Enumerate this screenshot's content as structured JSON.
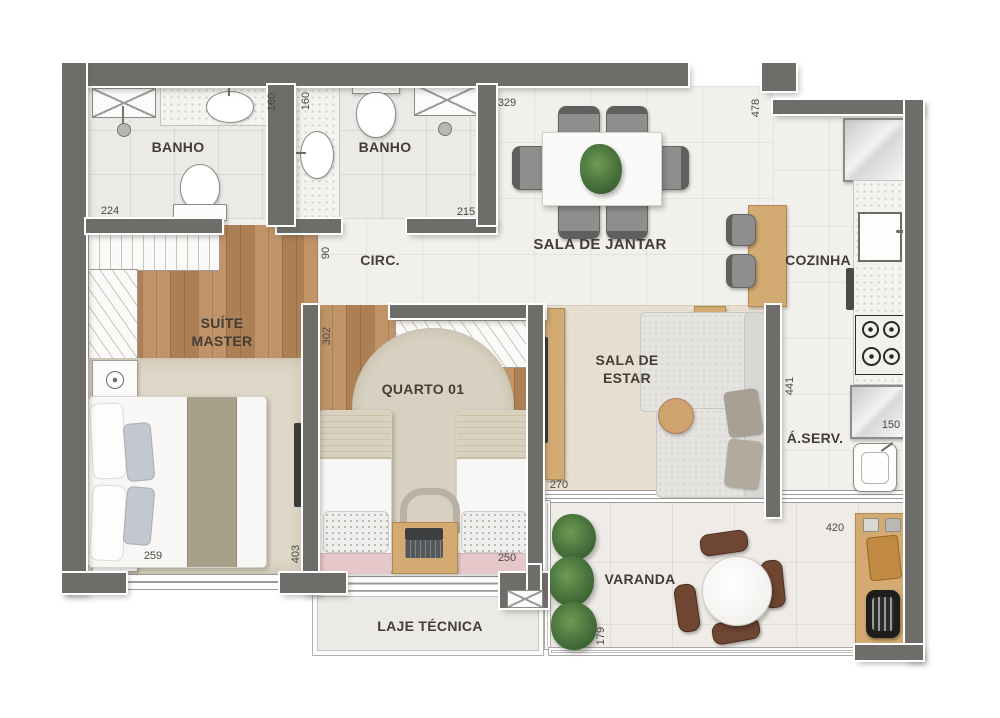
{
  "palette": {
    "wall": "#6f6d6a",
    "wood_floor": "#b98c60",
    "counter_wood": "#d3aa72",
    "plant_green": "#47703b"
  },
  "rooms": {
    "banho1": "BANHO",
    "banho2": "BANHO",
    "circ": "CIRC.",
    "sala_jantar": "SALA DE JANTAR",
    "cozinha": "COZINHA",
    "suite_master": {
      "line1": "SUÍTE",
      "line2": "MASTER"
    },
    "quarto01": "QUARTO 01",
    "sala_estar": {
      "line1": "SALA DE",
      "line2": "ESTAR"
    },
    "aserv": "Á.SERV.",
    "varanda": "VARANDA",
    "laje_tecnica": "LAJE TÉCNICA"
  },
  "dimensions_cm": {
    "banho1_width": "224",
    "banho1_depth": "160",
    "banho2_width": "215",
    "banho2_depth": "160",
    "circ_width": "90",
    "sala_jantar_width": "329",
    "social_depth": "478",
    "cozinha_depth": "441",
    "aserv_width": "150",
    "suite_width": "259",
    "suite_depth": "403",
    "quarto_depth": "302",
    "quarto_width": "250",
    "sala_estar_width": "270",
    "varanda_width": "420",
    "varanda_depth": "179"
  }
}
